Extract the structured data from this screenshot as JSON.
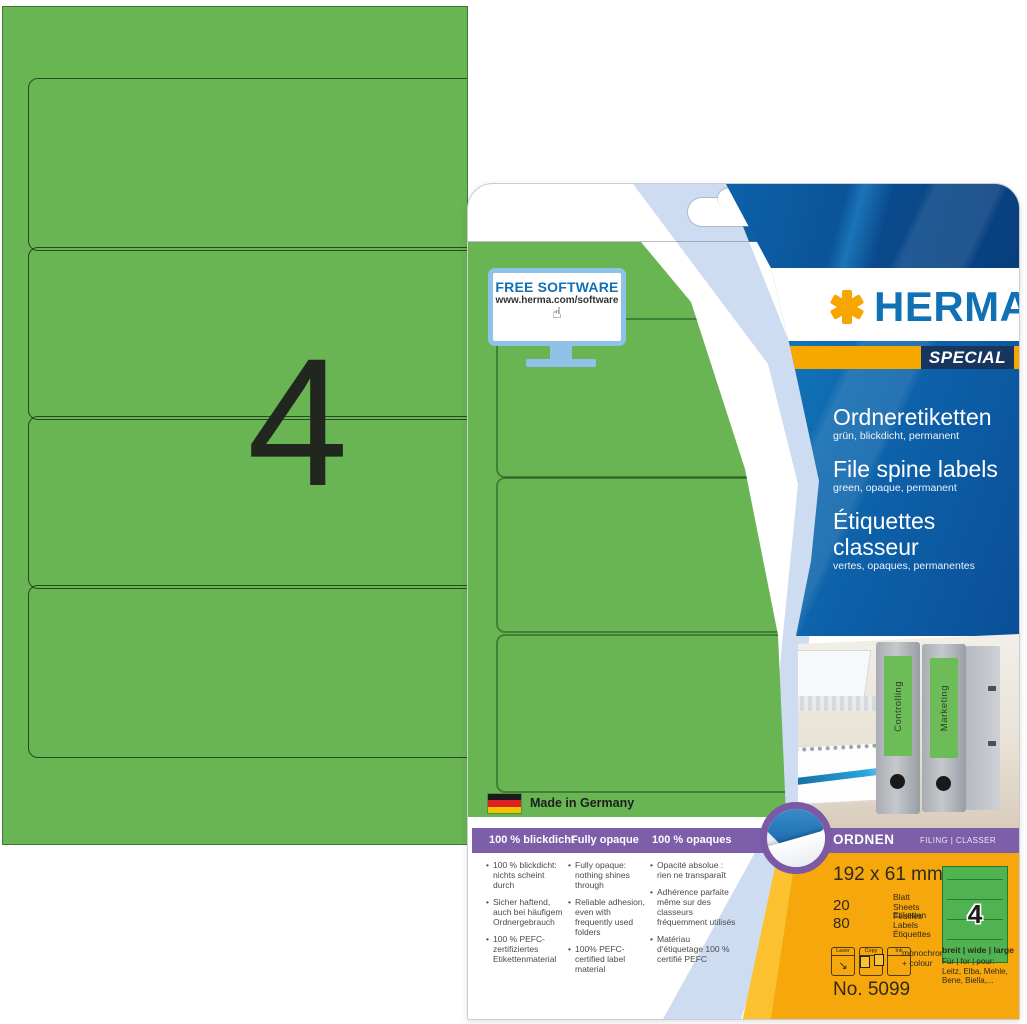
{
  "sheet": {
    "count": "4"
  },
  "package": {
    "free_software": {
      "title": "FREE SOFTWARE",
      "url": "www.herma.com/software",
      "cursor_glyph": "☝"
    },
    "brand": {
      "name": "HERMA",
      "special": "SPECIAL"
    },
    "products": [
      {
        "title": "Ordneretiketten",
        "subtitle": "grün, blickdicht, permanent"
      },
      {
        "title": "File spine labels",
        "subtitle": "green, opaque, permanent"
      },
      {
        "title": "Étiquettes classeur",
        "subtitle": "vertes, opaques, permanentes"
      }
    ],
    "made_in": "Made in Germany",
    "feature_band": [
      "100 % blickdicht",
      "Fully opaque",
      "100 % opaques"
    ],
    "features": {
      "de": [
        "100 % blickdicht: nichts scheint durch",
        "Sicher haftend, auch bei häufigem Ordnergebrauch",
        "100 % PEFC-zertifiziertes Etikettenmaterial"
      ],
      "en": [
        "Fully opaque: nothing shines through",
        "Reliable adhesion, even with frequently used folders",
        "100% PEFC-certified label material"
      ],
      "fr": [
        "Opacité absolue : rien ne transparaît",
        "Adhérence parfaite même sur des classeurs fréquemment utilisés",
        "Matériau d'étiquetage 100 % certifié PEFC"
      ]
    },
    "category_band": {
      "title": "ORDNEN",
      "subtitle": "FILING | CLASSER"
    },
    "photo_folders": [
      "Controlling",
      "Marketing"
    ],
    "specs": {
      "size": "192 x 61 mm",
      "sheets_count": "20",
      "sheets_labels": [
        "Blatt",
        "Sheets",
        "Feuilles"
      ],
      "labels_count": "80",
      "labels_labels": [
        "Etiketten",
        "Labels",
        "Étiquettes"
      ],
      "printer_icons": [
        "Laser",
        "Copy",
        "Ink"
      ],
      "print_note": [
        "monochrome",
        "+ colour"
      ],
      "mini_sheet_count": "4",
      "width_note": "breit | wide | large",
      "compat": [
        "Für | for | pour:",
        "Leitz, Elba, Mehle,",
        "Bene, Biella,..."
      ],
      "article_no": "No. 5099"
    },
    "icons": {
      "asterisk": "herma-asterisk-logo",
      "euro_slot": "hang-hole",
      "peel": "peel-label-icon",
      "flag": "german-flag-icon",
      "cursor": "hand-cursor-icon"
    }
  },
  "colors": {
    "green": "#6ab553",
    "blue": "#1171b5",
    "dark_navy": "#17365f",
    "orange": "#f6a800",
    "purple": "#7d5ea8",
    "light_blue_stripe": "#cddcf0"
  }
}
